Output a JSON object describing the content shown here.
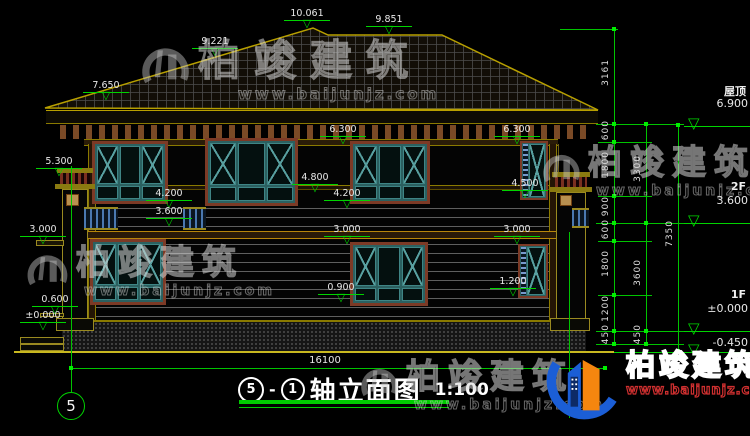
{
  "title": {
    "axis_start": "5",
    "separator": "-",
    "axis_end": "1",
    "name": "轴立面图",
    "scale": "1:100"
  },
  "axis_bubble": "5",
  "bottom_dimension": "16100",
  "elevation_marks": [
    {
      "label": "10.061"
    },
    {
      "label": "9.851"
    },
    {
      "label": "9.221"
    },
    {
      "label": "7.650"
    },
    {
      "label": "6.300"
    },
    {
      "label": "6.300"
    },
    {
      "label": "5.300"
    },
    {
      "label": "4.800"
    },
    {
      "label": "4.500"
    },
    {
      "label": "4.200"
    },
    {
      "label": "4.200"
    },
    {
      "label": "3.600"
    },
    {
      "label": "3.000"
    },
    {
      "label": "3.000"
    },
    {
      "label": "3.000"
    },
    {
      "label": "1.200"
    },
    {
      "label": "0.900"
    },
    {
      "label": "0.600"
    },
    {
      "label": "±0.000"
    }
  ],
  "levels": [
    {
      "name": "屋顶",
      "value": "6.900"
    },
    {
      "name": "2F",
      "value": "3.600"
    },
    {
      "name": "1F",
      "value": "±0.000"
    },
    {
      "name": "",
      "value": "-0.450"
    }
  ],
  "chains": {
    "col1": [
      "3161",
      "600",
      "1800",
      "900",
      "600",
      "1800",
      "1200",
      "450"
    ],
    "col2": [
      "3300",
      "3600",
      "450"
    ],
    "col3": [
      "7350"
    ]
  },
  "watermark": {
    "brand": "柏竣建筑",
    "url": "www.baijunjz.com"
  },
  "logo": {
    "brand": "柏竣建筑",
    "url": "www.baijunjz.com"
  },
  "icons": {
    "level_marker": "▽"
  }
}
